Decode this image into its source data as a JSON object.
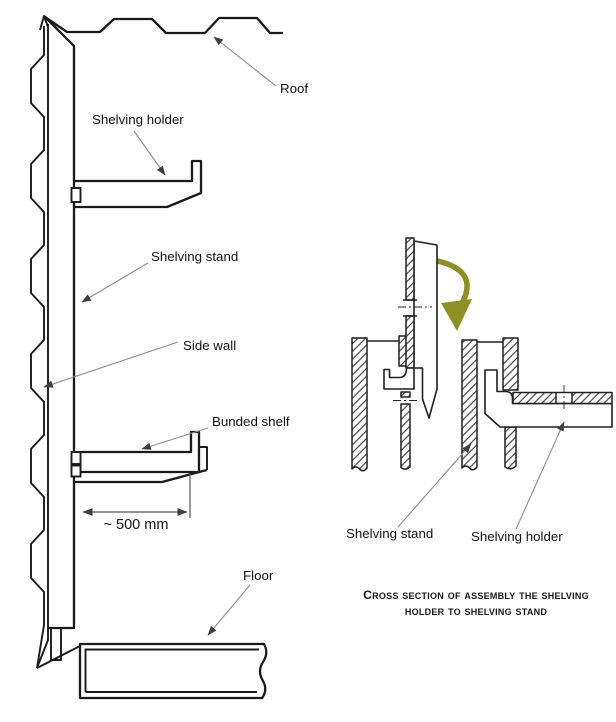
{
  "title": "Shelving assembly technical diagram",
  "left_view": {
    "roof_label": "Roof",
    "shelving_holder_label": "Shelving holder",
    "shelving_stand_label": "Shelving stand",
    "side_wall_label": "Side wall",
    "bunded_shelf_label": "Bunded shelf",
    "dimension_label": "~ 500 mm",
    "floor_label": "Floor"
  },
  "cross_section": {
    "shelving_stand_label": "Shelving stand",
    "shelving_holder_label": "Shelving holder",
    "caption_line1": "Cross section of assembly the shelving",
    "caption_line2": "holder to shelving stand"
  },
  "colors": {
    "line": "#1a1a1a",
    "leader": "#8c8c8c",
    "arrowhead": "#3f3f3f",
    "assembly_arrow": "#8f8f28",
    "background": "#ffffff"
  }
}
